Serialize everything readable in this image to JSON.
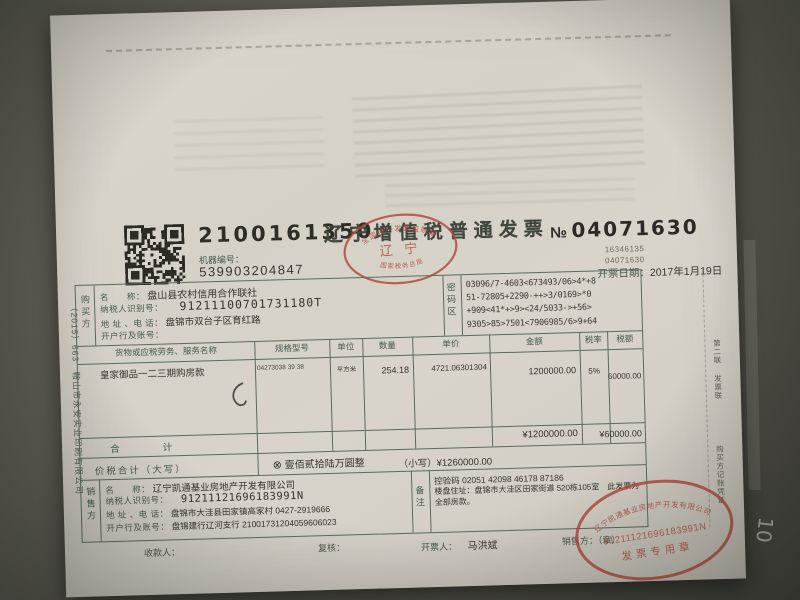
{
  "header": {
    "machine_code_top": "2100161350",
    "machine_no_label": "机器编号：",
    "machine_no": "539903204847",
    "title": "辽宁增值税普通发票",
    "no_symbol": "№",
    "invoice_no": "04071630",
    "small_no_1": "16346135",
    "small_no_2": "04071630",
    "date_label": "开票日期：",
    "date": "2017年1月19日"
  },
  "supervision_stamp": {
    "top_text": "全国统一发票监制章",
    "center_text": "辽 宁",
    "bottom_text": "国家税务总局"
  },
  "buyer": {
    "section_label": "购买方",
    "name_label": "名　　称：",
    "name": "盘山县农村信用合作联社",
    "tax_id_label": "纳税人识别号：",
    "tax_id": "91211100701731180T",
    "address_label": "地 址 、电 话：",
    "address": "盘锦市双台子区育红路",
    "bank_label": "开户行及账号：",
    "bank": ""
  },
  "password_area": {
    "section_label": "密码区",
    "lines": [
      "03096/7-4603<673493/06>4*+8",
      "51-72805+2290-++>3/0169>*0",
      "+909<41*+>9><24/5033->+56>",
      "9305>85>7501<7906985/6>9+64"
    ]
  },
  "items_table": {
    "headers": [
      "货物或应税劳务、服务名称",
      "规格型号",
      "单位",
      "数量",
      "单价",
      "金额",
      "税率",
      "税额"
    ],
    "rows": [
      {
        "name": "皇家御品一二三期购房款",
        "spec": "04273038 39 38",
        "unit": "平方米",
        "qty": "254.18",
        "price": "4721.06301304",
        "amount": "1200000.00",
        "tax_rate": "5%",
        "tax": "60000.00"
      }
    ],
    "total_label": "合　　计",
    "total_amount": "¥1200000.00",
    "total_tax": "¥60000.00"
  },
  "total_row": {
    "label": "价税合计（大写）",
    "symbol": "⊗",
    "amount_words": "壹佰贰拾陆万圆整",
    "small_text": "（小写）¥1260000.00"
  },
  "seller": {
    "section_label": "销售方",
    "name_label": "名　　称：",
    "name": "辽宁凯通基业房地产开发有限公司",
    "tax_id_label": "纳税人识别号：",
    "tax_id": "91211121696183991N",
    "address_label": "地 址 、电 话：",
    "address": "盘锦市大洼县田家镇高家村 0427-2919666",
    "bank_label": "开户行及账号：",
    "bank": "盘锦建行辽河支行 21001731204059606023"
  },
  "remarks": {
    "section_label": "备注",
    "line1": "控验码 02051 42098 46178 87186",
    "line2": "楼盘住址：盘锦市大洼区田家街道 520栋105室　此发票为全部房款。"
  },
  "seller_stamp": {
    "arc_text": "辽宁凯通基业房地产开发有限公司",
    "number": "91211121696183991N",
    "bottom_text": "发票专用章"
  },
  "footer": {
    "payee_label": "收款人：",
    "reviewer_label": "复核：",
    "drawer_label": "开票人：",
    "drawer": "马洪斌",
    "seller_seal_label": "销售方：（章）"
  },
  "margins": {
    "left_print_info": "（2015）663　鞍山市永安实业印刷有限公司",
    "right_copy_label": "第二联 发票联",
    "right_copy_use": "购买方记账凭证",
    "handwritten_note": "10"
  }
}
